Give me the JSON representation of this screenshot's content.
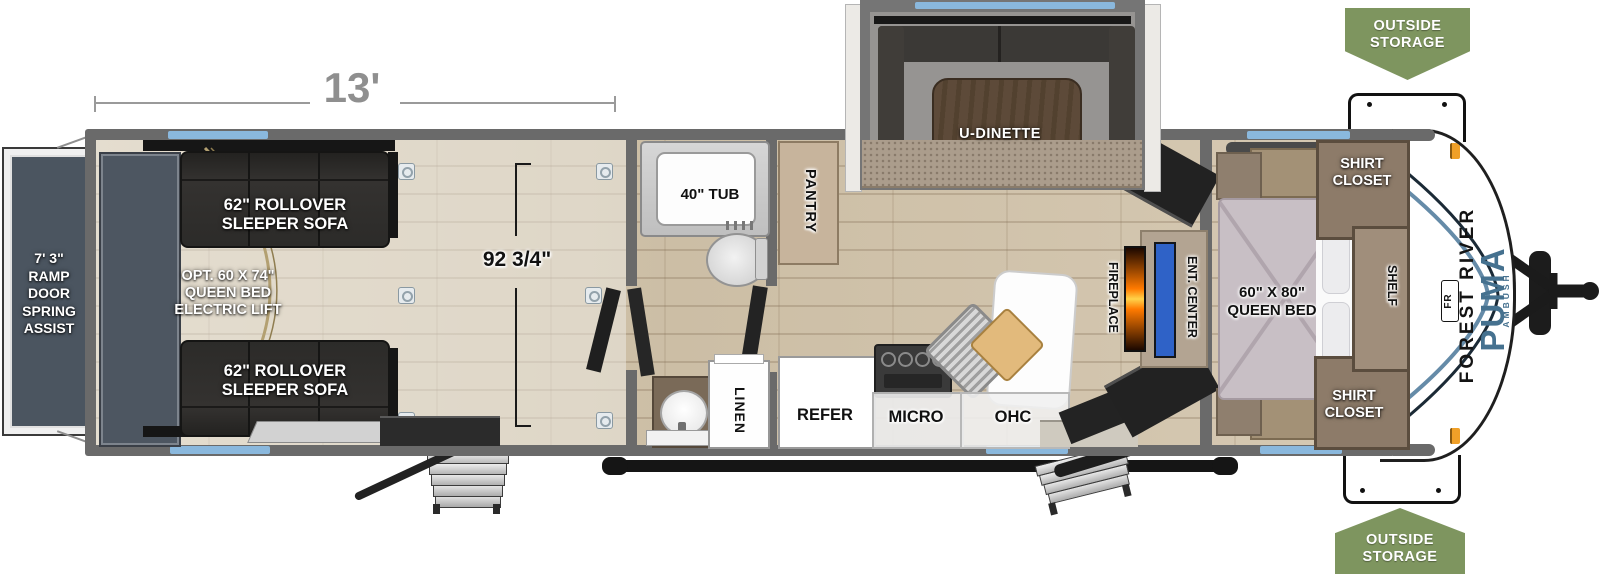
{
  "title": "Toy hauler travel trailer floorplan",
  "colors": {
    "wall_gray": "#6a6a6a",
    "window_blue": "#8ab8dd",
    "banner_green": "#7e955f",
    "ramp_slate": "#4b5560",
    "tv_blue": "#2f62c7",
    "fireplace_orange": "#ff7a00",
    "brand_blue": "#45718f",
    "floor_wood": "#d3c6b0"
  },
  "dimensions": {
    "garage_length": "13'",
    "garage_width": "92 3/4\""
  },
  "exterior": {
    "outside_storage": "OUTSIDE\nSTORAGE",
    "ramp_door": "7' 3\"\nRAMP DOOR\nSPRING\nASSIST",
    "brand": {
      "manufacturer": "FOREST RIVER",
      "model": "PUMA",
      "series": "AMBUSH",
      "emblem": "FR"
    }
  },
  "garage": {
    "sofa": "62\" ROLLOVER\nSLEEPER SOFA",
    "opt_bed": "OPT. 60 X 74\"\nQUEEN BED\nELECTRIC LIFT"
  },
  "bath": {
    "tub": "40\" TUB",
    "linen": "LINEN"
  },
  "kitchen": {
    "pantry": "PANTRY",
    "refer": "REFER",
    "micro": "MICRO",
    "ohc": "OHC",
    "dinette": "U-DINETTE"
  },
  "living": {
    "fireplace": "FIREPLACE",
    "ent_center": "ENT. CENTER"
  },
  "bedroom": {
    "bed": "60\" X 80\"\nQUEEN BED",
    "shirt_closet": "SHIRT\nCLOSET",
    "shelf": "SHELF"
  }
}
